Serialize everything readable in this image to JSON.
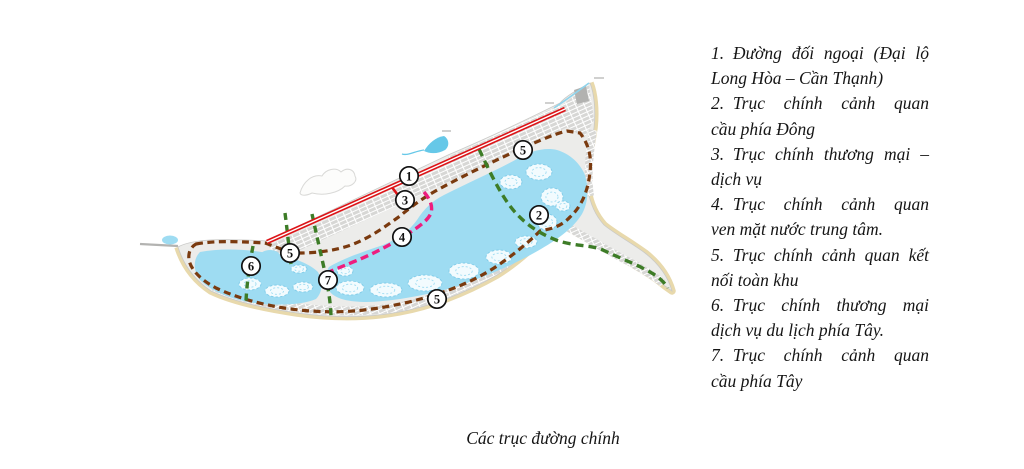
{
  "legend": {
    "items": [
      {
        "lines": [
          "1. Đường đối ngoại (Đại lộ",
          "Long Hòa – Cần Thạnh)"
        ]
      },
      {
        "lines": [
          "2. Trục chính cảnh quan",
          "cầu phía Đông"
        ]
      },
      {
        "lines": [
          "3. Trục chính thương mại –",
          "dịch vụ"
        ]
      },
      {
        "lines": [
          "4. Trục chính cảnh quan",
          "ven mặt nước trung tâm."
        ]
      },
      {
        "lines": [
          "5. Trục chính cảnh quan kết",
          "nối toàn khu"
        ]
      },
      {
        "lines": [
          "6. Trục chính thương mại",
          "dịch vụ du lịch phía Tây."
        ]
      },
      {
        "lines": [
          "7. Trục chính cảnh quan",
          "cầu phía Tây"
        ]
      }
    ]
  },
  "caption": "Các trục đường chính",
  "map": {
    "colors": {
      "water": "#9edcf2",
      "land": "#ececea",
      "beach": "#e8d9ac",
      "route_red": "#dd1418",
      "route_brown": "#7a3a0f",
      "route_green": "#3d7c27",
      "route_pink": "#ee1d7e",
      "marker_stroke": "#111111"
    },
    "routes": [
      {
        "name": "route-5-brown-loop",
        "color": "#7a3a0f",
        "width": 3.2,
        "dash": "7 4.5",
        "d": "M196,244 C218,240 246,242 265,243 C277,247 288,253 299,253 C315,253 334,251 351,245 C370,238 386,226 400,216 C413,205 426,196 441,188 C465,175 492,162 514,152 C532,144 553,134 567,131 L580,133 C588,143 592,156 590,172 C588,192 581,207 570,217 C561,227 550,229 540,231 C529,242 512,256 494,268 C475,280 456,288 437,294 C416,301 390,307 364,310 C338,313 310,312 284,308 C259,304 235,297 216,288 C201,280 191,270 189,260 C188,252 191,247 196,244 Z"
      },
      {
        "name": "route-2-green-east",
        "color": "#3d7c27",
        "width": 3.4,
        "dash": "8 5",
        "d": "M479,149 C488,168 498,190 510,206 C522,222 538,233 556,240 C575,247 591,244 605,251 C622,259 638,265 650,272 C659,277 665,283 668,288"
      },
      {
        "name": "route-7-green-center",
        "color": "#3d7c27",
        "width": 3.4,
        "dash": "7 5",
        "d": "M312,214 C317,237 322,259 326,277 C329,293 331,307 331,318"
      },
      {
        "name": "route-6-green-west",
        "color": "#3d7c27",
        "width": 3.4,
        "dash": "7 5",
        "d": "M253,246 C250,262 247,281 246,301"
      },
      {
        "name": "green-west-bridge-stub",
        "color": "#3d7c27",
        "width": 3.4,
        "dash": "7 5",
        "d": "M285,213 C287,228 289,248 291,264"
      },
      {
        "name": "route-3-4-pink",
        "color": "#ee1d7e",
        "width": 3.4,
        "dash": "8 4.5",
        "d": "M424,192 C430,199 433,206 431,213 C428,221 417,228 403,237 C388,246 371,255 353,262 C341,267 333,270 327,273"
      },
      {
        "name": "route-1-red-branch",
        "color": "#dd1418",
        "width": 2.6,
        "dash": "",
        "d": "M391,186 L404,203"
      },
      {
        "name": "route-1-red-main",
        "color": "#dd1418",
        "width": 4.6,
        "dash": "",
        "d": "M565,109 L267,242",
        "casing": "#ffffff"
      }
    ],
    "markers": [
      {
        "label": "1",
        "x": 409,
        "y": 176
      },
      {
        "label": "3",
        "x": 405,
        "y": 200
      },
      {
        "label": "4",
        "x": 402,
        "y": 237
      },
      {
        "label": "5",
        "x": 523,
        "y": 150
      },
      {
        "label": "2",
        "x": 539,
        "y": 215
      },
      {
        "label": "5",
        "x": 290,
        "y": 253
      },
      {
        "label": "6",
        "x": 251,
        "y": 266
      },
      {
        "label": "7",
        "x": 328,
        "y": 280
      },
      {
        "label": "5",
        "x": 437,
        "y": 299
      }
    ],
    "islands": [
      [
        350,
        288,
        14,
        7
      ],
      [
        386,
        290,
        16,
        7
      ],
      [
        425,
        283,
        17,
        8
      ],
      [
        464,
        271,
        15,
        8
      ],
      [
        499,
        257,
        13,
        7
      ],
      [
        526,
        242,
        11,
        6
      ],
      [
        547,
        222,
        10,
        8
      ],
      [
        552,
        197,
        11,
        9
      ],
      [
        539,
        172,
        13,
        8
      ],
      [
        511,
        182,
        11,
        7
      ],
      [
        563,
        206,
        7,
        5
      ],
      [
        345,
        271,
        8,
        5
      ],
      [
        250,
        284,
        11,
        6
      ],
      [
        277,
        291,
        12,
        6
      ],
      [
        303,
        287,
        10,
        5
      ],
      [
        299,
        269,
        8,
        4
      ]
    ]
  }
}
